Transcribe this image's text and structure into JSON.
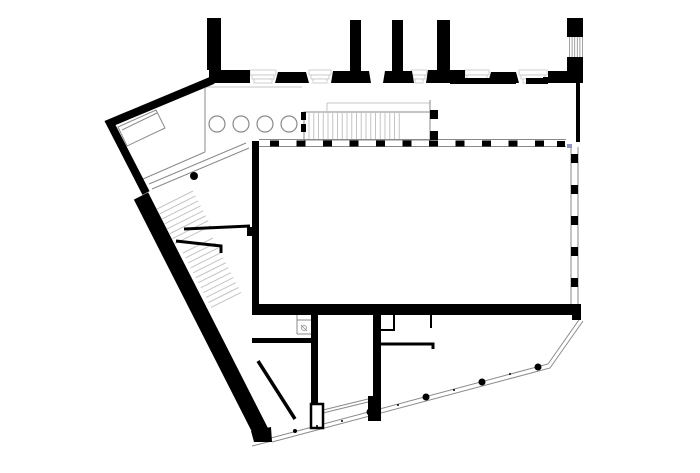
{
  "canvas": {
    "width": 700,
    "height": 473,
    "background": "#ffffff"
  },
  "palette": {
    "ink": "#000000",
    "line": "#8a8a8a",
    "light": "#c4c4c4",
    "paper": "#ffffff",
    "artifact": "#9097c4"
  },
  "plan": {
    "white_boxes": [
      {
        "name": "north-stair-enclosure",
        "kind": "rect",
        "x": 304,
        "y": 112,
        "w": 126,
        "h": 28
      },
      {
        "name": "reception-desk",
        "kind": "polygon",
        "pts": "156,110 165,128 127,146 118,127"
      }
    ],
    "combs": [
      {
        "name": "north-stair-treads",
        "x0": 309,
        "y0": 113,
        "dx": 4.75,
        "dy": 0,
        "n": 20,
        "tx": 0,
        "ty": 26,
        "color": "light",
        "w": 1
      },
      {
        "name": "main-stair-upper-flight",
        "x0": 157,
        "y0": 209,
        "dx": 2.55,
        "dy": 4.95,
        "n": 8,
        "tx": 36,
        "ty": -18,
        "color": "light",
        "w": 1
      },
      {
        "name": "main-stair-lower-flight",
        "x0": 183,
        "y0": 253,
        "dx": 2.55,
        "dy": 4.95,
        "n": 12,
        "tx": 30,
        "ty": -15,
        "color": "light",
        "w": 1
      },
      {
        "name": "corner-column-flutes",
        "x0": 569.5,
        "y0": 37,
        "dx": 2.6,
        "dy": 0,
        "n": 6,
        "tx": 0,
        "ty": 22,
        "color": "line",
        "w": 0.8
      }
    ],
    "thin_strokes": [
      {
        "name": "nw-room-edge-vertical",
        "pts": "205,87 205,152",
        "w": 1,
        "color": "line"
      },
      {
        "name": "nw-room-edge-diagonal",
        "pts": "205,152 143,179",
        "w": 1,
        "color": "line"
      },
      {
        "name": "entry-ramp-line-a",
        "pts": "246,143 149,184",
        "w": 1,
        "color": "line"
      },
      {
        "name": "entry-ramp-line-b",
        "pts": "249,148 152,189",
        "w": 1,
        "color": "line"
      },
      {
        "name": "nw-wing-face-line",
        "pts": "205,87 302,87",
        "w": 1,
        "color": "light"
      },
      {
        "name": "stair-void-edge",
        "pts": "327,103 430,103",
        "w": 1,
        "color": "light"
      },
      {
        "name": "stair-void-vertical",
        "pts": "327,103 327,112",
        "w": 1,
        "color": "light"
      },
      {
        "name": "stair-right-edge",
        "pts": "430,100 430,141",
        "w": 1,
        "color": "line"
      },
      {
        "name": "hall-north-glazing-top",
        "pts": "259,139.5 566,139.5",
        "w": 1,
        "color": "line"
      },
      {
        "name": "hall-north-glazing-bottom",
        "pts": "259,146.5 566,146.5",
        "w": 1,
        "color": "line"
      },
      {
        "name": "hall-east-glazing-left",
        "pts": "571,147 571,304",
        "w": 1,
        "color": "line"
      },
      {
        "name": "hall-east-glazing-right",
        "pts": "578,147 578,304",
        "w": 1,
        "color": "line"
      },
      {
        "name": "se-facade-outer-line",
        "pts": "581,317 548,364 271,438",
        "w": 1,
        "color": "line"
      },
      {
        "name": "se-facade-inner-line",
        "pts": "583,321 550,368 272,442",
        "w": 1,
        "color": "line"
      },
      {
        "name": "sw-plinth-tip-line",
        "pts": "252,446 272,441",
        "w": 1,
        "color": "line"
      },
      {
        "name": "core-south-glazing-a",
        "pts": "323,410 368,399",
        "w": 1,
        "color": "line"
      },
      {
        "name": "core-south-glazing-b",
        "pts": "323,413 368,402",
        "w": 1,
        "color": "line"
      },
      {
        "name": "shaft-room-left-edge",
        "pts": "297,315 297,334",
        "w": 1,
        "color": "line"
      },
      {
        "name": "shaft-room-bottom-edge",
        "pts": "297,334 311,334",
        "w": 1,
        "color": "line"
      },
      {
        "name": "shaft-room-shelf",
        "pts": "297,320 311,320",
        "w": 1,
        "color": "line"
      },
      {
        "name": "desk-fold-line",
        "pts": "122,130 157,113",
        "w": 1,
        "color": "line"
      },
      {
        "name": "shaft-symbol-cross",
        "pts": "301,325 307,331",
        "w": 0.8,
        "color": "line"
      }
    ],
    "profiles": [
      {
        "name": "facade-base-profile-1",
        "x": 250,
        "w": 26
      },
      {
        "name": "facade-base-profile-2",
        "x": 309,
        "w": 22
      },
      {
        "name": "facade-base-profile-3",
        "x": 411,
        "w": 16
      },
      {
        "name": "facade-base-profile-4",
        "x": 465,
        "w": 24
      },
      {
        "name": "facade-base-profile-5",
        "x": 519,
        "w": 28
      }
    ],
    "mullions": [
      {
        "name": "hall-north-glazing-posts",
        "x0": 270,
        "y0": 140.5,
        "dx": 26.5,
        "dy": 0,
        "n": 11,
        "w": 9,
        "h": 6
      },
      {
        "name": "hall-east-glazing-posts",
        "x0": 571,
        "y0": 154,
        "dx": 0,
        "dy": 31,
        "n": 5,
        "w": 7,
        "h": 9
      }
    ],
    "ink_shapes": [
      {
        "name": "facade-pier-a",
        "kind": "rect",
        "x": 207,
        "y": 18,
        "w": 14,
        "h": 52
      },
      {
        "name": "facade-band-left",
        "kind": "rect",
        "x": 209,
        "y": 70,
        "w": 41,
        "h": 13
      },
      {
        "name": "facade-pier-b",
        "kind": "rect",
        "x": 350,
        "y": 20,
        "w": 11,
        "h": 52
      },
      {
        "name": "facade-pier-c",
        "kind": "rect",
        "x": 392,
        "y": 20,
        "w": 11,
        "h": 52
      },
      {
        "name": "facade-pier-d",
        "kind": "rect",
        "x": 437,
        "y": 20,
        "w": 13,
        "h": 52
      },
      {
        "name": "corner-pier-cap",
        "kind": "rect",
        "x": 567,
        "y": 18,
        "w": 16,
        "h": 19
      },
      {
        "name": "facade-band-base-1",
        "kind": "rect",
        "x": 450,
        "y": 78,
        "w": 66,
        "h": 6
      },
      {
        "name": "facade-band-base-2",
        "kind": "rect",
        "x": 526,
        "y": 78,
        "w": 22,
        "h": 6
      },
      {
        "name": "upper-east-wall",
        "kind": "rect",
        "x": 576,
        "y": 83,
        "w": 4,
        "h": 59
      },
      {
        "name": "hall-west-wall",
        "kind": "rect",
        "x": 252,
        "y": 141,
        "w": 7,
        "h": 174
      },
      {
        "name": "hall-west-pilaster",
        "kind": "rect",
        "x": 247,
        "y": 227,
        "w": 5,
        "h": 9
      },
      {
        "name": "hall-south-wall",
        "kind": "rect",
        "x": 252,
        "y": 304,
        "w": 329,
        "h": 11
      },
      {
        "name": "hall-se-corner-post",
        "kind": "rect",
        "x": 572,
        "y": 304,
        "w": 9,
        "h": 16
      },
      {
        "name": "core-west-wall",
        "kind": "rect",
        "x": 311,
        "y": 315,
        "w": 7,
        "h": 92
      },
      {
        "name": "core-east-wall",
        "kind": "rect",
        "x": 373,
        "y": 315,
        "w": 8,
        "h": 84
      },
      {
        "name": "core-east-block",
        "kind": "rect",
        "x": 368,
        "y": 396,
        "w": 13,
        "h": 25
      },
      {
        "name": "south-partition-wall",
        "kind": "rect",
        "x": 252,
        "y": 338,
        "w": 59,
        "h": 5
      },
      {
        "name": "hall-ne-corner-post",
        "kind": "rect",
        "x": 557,
        "y": 141,
        "w": 8,
        "h": 6
      },
      {
        "name": "north-stair-mullion-a",
        "kind": "rect",
        "x": 301,
        "y": 112,
        "w": 5,
        "h": 8
      },
      {
        "name": "north-stair-mullion-b",
        "kind": "rect",
        "x": 301,
        "y": 124,
        "w": 5,
        "h": 8
      },
      {
        "name": "north-stair-post-a",
        "kind": "rect",
        "x": 430,
        "y": 110,
        "w": 8,
        "h": 9
      },
      {
        "name": "north-stair-post-b",
        "kind": "rect",
        "x": 430,
        "y": 131,
        "w": 8,
        "h": 9
      },
      {
        "name": "facade-pilaster-1",
        "kind": "polygon",
        "pts": "278,72 306,72 309,83 275,83"
      },
      {
        "name": "pier-b-foot",
        "kind": "polygon",
        "pts": "333,71 369,71 371,83 331,83"
      },
      {
        "name": "pier-c-foot",
        "kind": "polygon",
        "pts": "385,71 412,71 414,83 383,83"
      },
      {
        "name": "pier-d-foot",
        "kind": "polygon",
        "pts": "428,70 465,70 465,83 426,83"
      },
      {
        "name": "facade-pilaster-2",
        "kind": "polygon",
        "pts": "491,72 516,72 519,83 488,83"
      },
      {
        "name": "corner-pier-base",
        "kind": "polygon",
        "pts": "548,71 567,71 567,57 583,57 583,83 543,83 543,77 548,77"
      },
      {
        "name": "diagonal-wall-cap",
        "kind": "polygon",
        "pts": "251,431 271,427 272,442 254,442"
      },
      {
        "name": "nw-facade-wall",
        "kind": "stroke",
        "pts": "213,80 110,123 146,193",
        "w": 8
      },
      {
        "name": "main-diagonal-wall",
        "kind": "stroke",
        "pts": "141,196 262,434",
        "w": 16
      },
      {
        "name": "stair-flank-wall-a",
        "kind": "stroke",
        "pts": "184,229 250,226",
        "w": 3
      },
      {
        "name": "stair-flank-wall-b",
        "kind": "stroke",
        "pts": "176,241 221,246 221,253",
        "w": 3
      },
      {
        "name": "lower-diagonal-partition",
        "kind": "stroke",
        "pts": "258,361 295,419",
        "w": 3.5
      },
      {
        "name": "room-partition-a",
        "kind": "stroke",
        "pts": "394,315 394,330 380,330",
        "w": 2
      },
      {
        "name": "room-partition-b",
        "kind": "stroke",
        "pts": "431,315 431,328",
        "w": 2
      },
      {
        "name": "room-partition-c",
        "kind": "stroke",
        "pts": "378,344 433,344 433,349",
        "w": 3
      }
    ],
    "outlined_ink": [
      {
        "name": "core-closet",
        "kind": "rect",
        "x": 311,
        "y": 404,
        "w": 12,
        "h": 24,
        "sw": 2.5
      }
    ],
    "circles": [
      {
        "name": "colonnade-column-1",
        "cx": 217,
        "cy": 124,
        "r": 8,
        "fill": "paper",
        "stroke": "line",
        "sw": 1.2
      },
      {
        "name": "colonnade-column-2",
        "cx": 241,
        "cy": 124,
        "r": 8,
        "fill": "paper",
        "stroke": "line",
        "sw": 1.2
      },
      {
        "name": "colonnade-column-3",
        "cx": 265,
        "cy": 124,
        "r": 8,
        "fill": "paper",
        "stroke": "line",
        "sw": 1.2
      },
      {
        "name": "colonnade-column-4",
        "cx": 289,
        "cy": 124,
        "r": 8,
        "fill": "paper",
        "stroke": "line",
        "sw": 1.2
      },
      {
        "name": "ramp-column",
        "cx": 194,
        "cy": 176,
        "r": 4,
        "fill": "ink"
      },
      {
        "name": "se-facade-column-1",
        "cx": 538,
        "cy": 367,
        "r": 3.5,
        "fill": "ink"
      },
      {
        "name": "se-facade-column-2",
        "cx": 482,
        "cy": 382,
        "r": 3.5,
        "fill": "ink"
      },
      {
        "name": "se-facade-column-3",
        "cx": 426,
        "cy": 397,
        "r": 3.5,
        "fill": "ink"
      },
      {
        "name": "se-facade-column-4",
        "cx": 370,
        "cy": 412,
        "r": 3.5,
        "fill": "ink"
      },
      {
        "name": "se-facade-column-5",
        "cx": 295,
        "cy": 431,
        "r": 2,
        "fill": "ink"
      },
      {
        "name": "se-facade-tick-1",
        "cx": 510,
        "cy": 374,
        "r": 1,
        "fill": "ink"
      },
      {
        "name": "se-facade-tick-2",
        "cx": 454,
        "cy": 390,
        "r": 1,
        "fill": "ink"
      },
      {
        "name": "se-facade-tick-3",
        "cx": 398,
        "cy": 405,
        "r": 1,
        "fill": "ink"
      },
      {
        "name": "se-facade-tick-4",
        "cx": 342,
        "cy": 421,
        "r": 1,
        "fill": "ink"
      },
      {
        "name": "se-facade-tick-5",
        "cx": 317,
        "cy": 426,
        "r": 1,
        "fill": "ink"
      },
      {
        "name": "shaft-symbol",
        "cx": 304,
        "cy": 328,
        "r": 2.5,
        "fill": "none",
        "stroke": "line",
        "sw": 0.8
      }
    ],
    "marks": [
      {
        "name": "render-artifact",
        "kind": "rect",
        "x": 567,
        "y": 144,
        "w": 5,
        "h": 4,
        "color": "artifact"
      }
    ]
  }
}
